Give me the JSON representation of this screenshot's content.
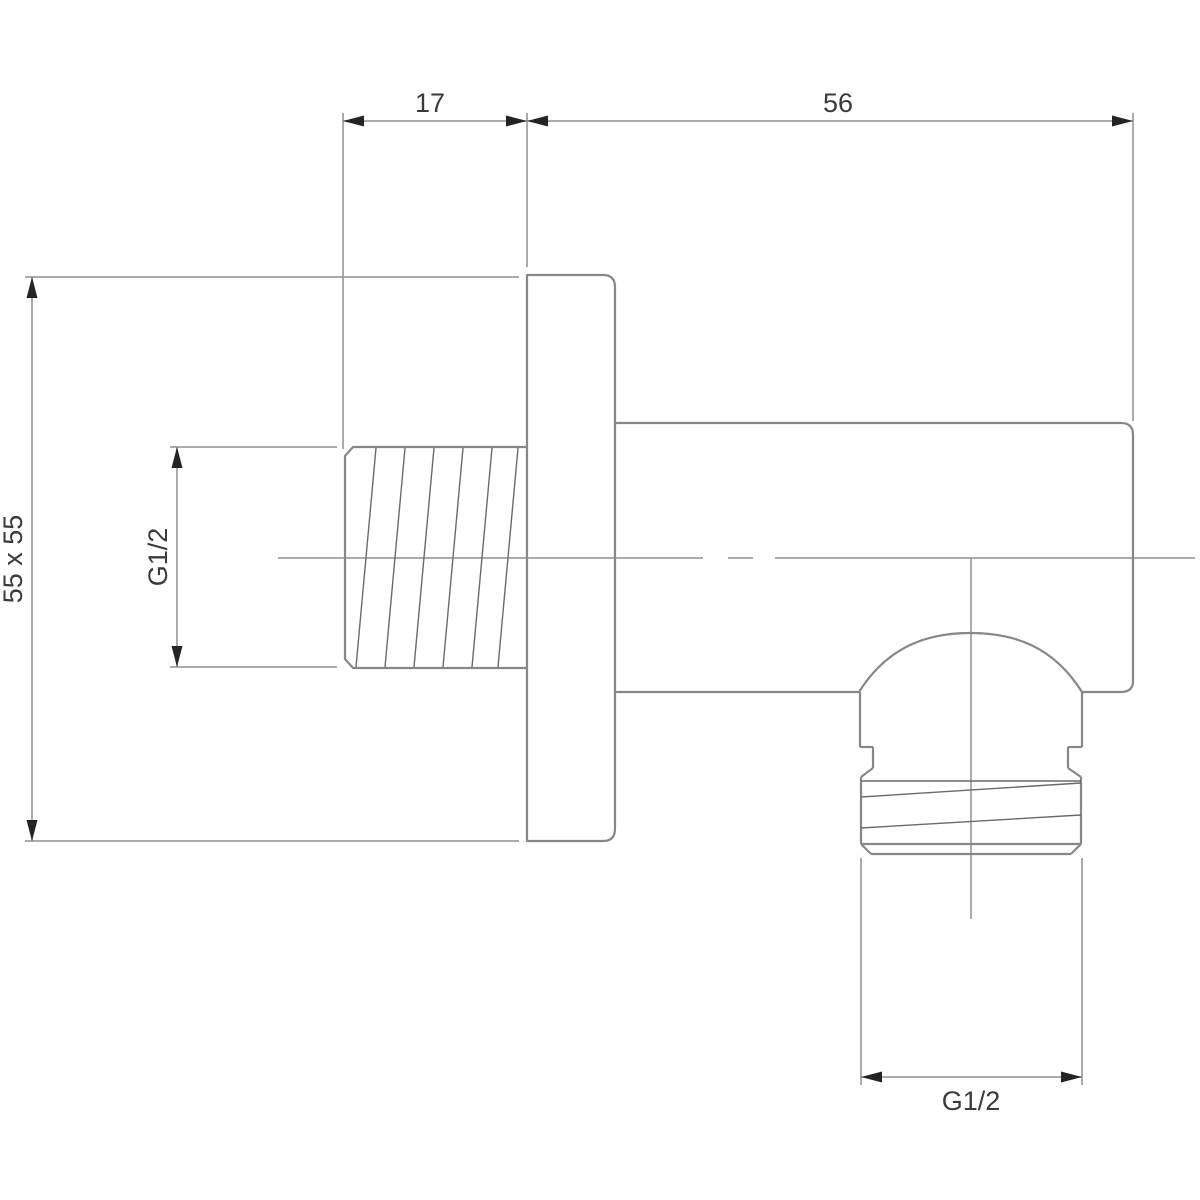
{
  "drawing": {
    "type": "technical-dimension-drawing",
    "subject": "shower wall outlet elbow, side section view",
    "labels": {
      "nipple_length_dim": "17",
      "projection_dim": "56",
      "plate_size_dim": "55 x 55",
      "rear_thread_dim": "G1/2",
      "bottom_thread_dim": "G1/2"
    },
    "colors": {
      "background": "#ffffff",
      "outline": "#878787",
      "thread_line": "#6a6a6a",
      "dimension_line": "#8f8f8f",
      "arrow": "#242424",
      "text": "#3a3a3a"
    }
  }
}
